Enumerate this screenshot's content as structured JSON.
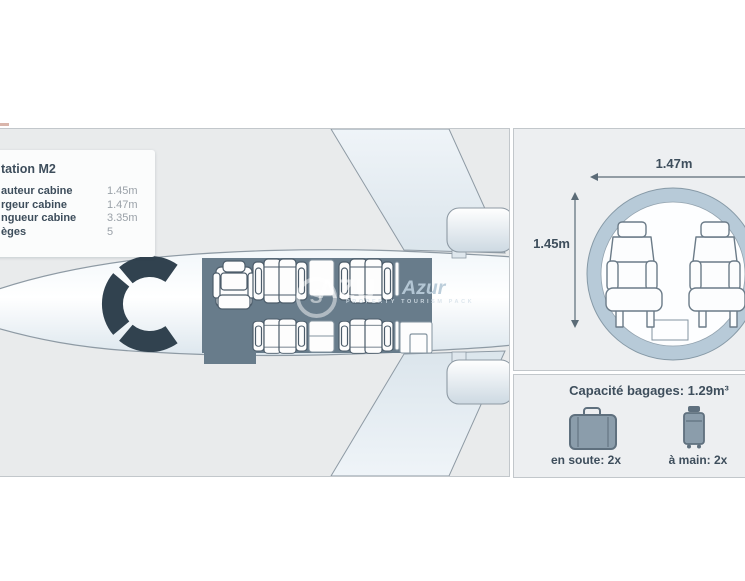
{
  "specs_box": {
    "title": "tation M2",
    "rows": [
      {
        "label": "auteur cabine",
        "value": "1.45m"
      },
      {
        "label": "rgeur cabine",
        "value": "1.47m"
      },
      {
        "label": "ngueur cabine",
        "value": "3.35m"
      },
      {
        "label": "èges",
        "value": "5"
      }
    ]
  },
  "cross_section": {
    "width_label": "1.47m",
    "height_label": "1.45m"
  },
  "baggage": {
    "title": "Capacité bagages: 1.29m³",
    "hold_label": "en soute: 2x",
    "hand_label": "à main: 2x"
  },
  "watermark": {
    "logo_letter": "S",
    "light_text": "AZU",
    "accent_text": "Azur",
    "caption": "PROPERTY TOURISM PACK"
  },
  "colors": {
    "panel-bg": "#e9ebec",
    "panel-bg-right": "#edeff1",
    "panel-border": "#c2c7cb",
    "text-dark": "#3e4e5c",
    "text-gray": "#9aa1a8",
    "cabin-fill": "#687c8b",
    "cockpit-fill": "#31424f",
    "outline": "#8e9aa4",
    "seat-stroke": "#4c5c6a",
    "ring-fill": "#b7cad8",
    "ring-stroke": "#8699a6",
    "bag-fill": "#8b9dab",
    "bag-stroke": "#5f707e",
    "arrow": "#5b6b77",
    "box-bg": "#fbfcfc"
  }
}
